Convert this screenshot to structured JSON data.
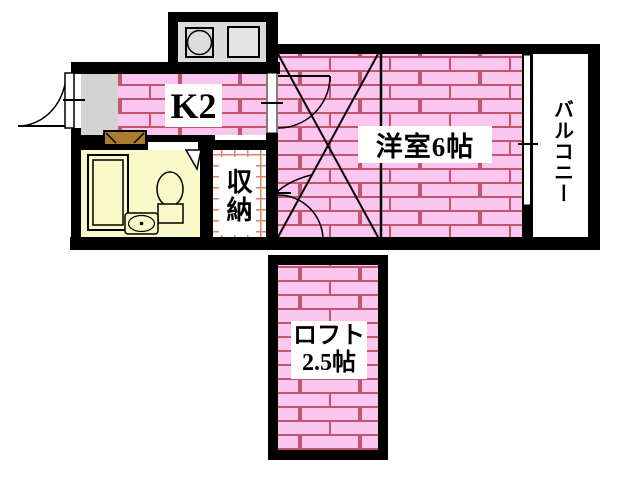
{
  "colors": {
    "floor_pink": "#FAC5EF",
    "brick_line": "#C2566C",
    "wall_black": "#000000",
    "bath_yellow": "#FAF9C8",
    "entry_gray": "#D3D3D3",
    "counter_gray": "#DBDBDB",
    "storage_grid_line": "#D8836C",
    "step_brown": "#AA7D2E",
    "label_text": "#000000",
    "label_bg": "#FFFFFF"
  },
  "rooms": {
    "kitchen": {
      "label": "K2"
    },
    "western_room": {
      "label": "洋室6帖"
    },
    "storage": {
      "label": "収納"
    },
    "balcony": {
      "label": "バルコニー"
    },
    "loft": {
      "label_line1": "ロフト",
      "label_line2": "2.5帖"
    }
  }
}
